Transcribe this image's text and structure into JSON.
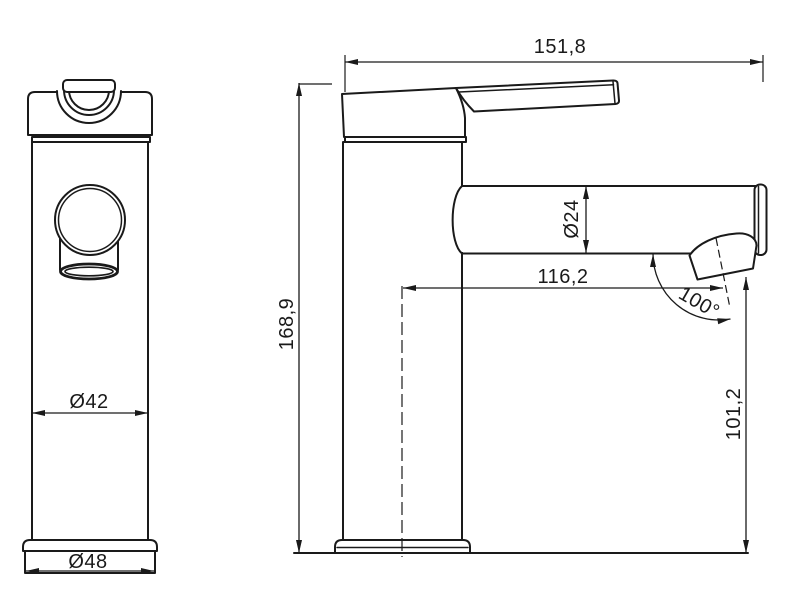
{
  "drawing": {
    "background_color": "#ffffff",
    "line_color": "#1a1a1a",
    "description": "Two-view dimensioned technical drawing of a single-lever basin faucet"
  },
  "dimensions": {
    "overall_width": "151,8",
    "overall_height": "168,9",
    "spout_diameter": "Ø24",
    "spout_reach": "116,2",
    "spout_angle": "100°",
    "outlet_height": "101,2",
    "body_diameter": "Ø42",
    "base_diameter": "Ø48"
  }
}
